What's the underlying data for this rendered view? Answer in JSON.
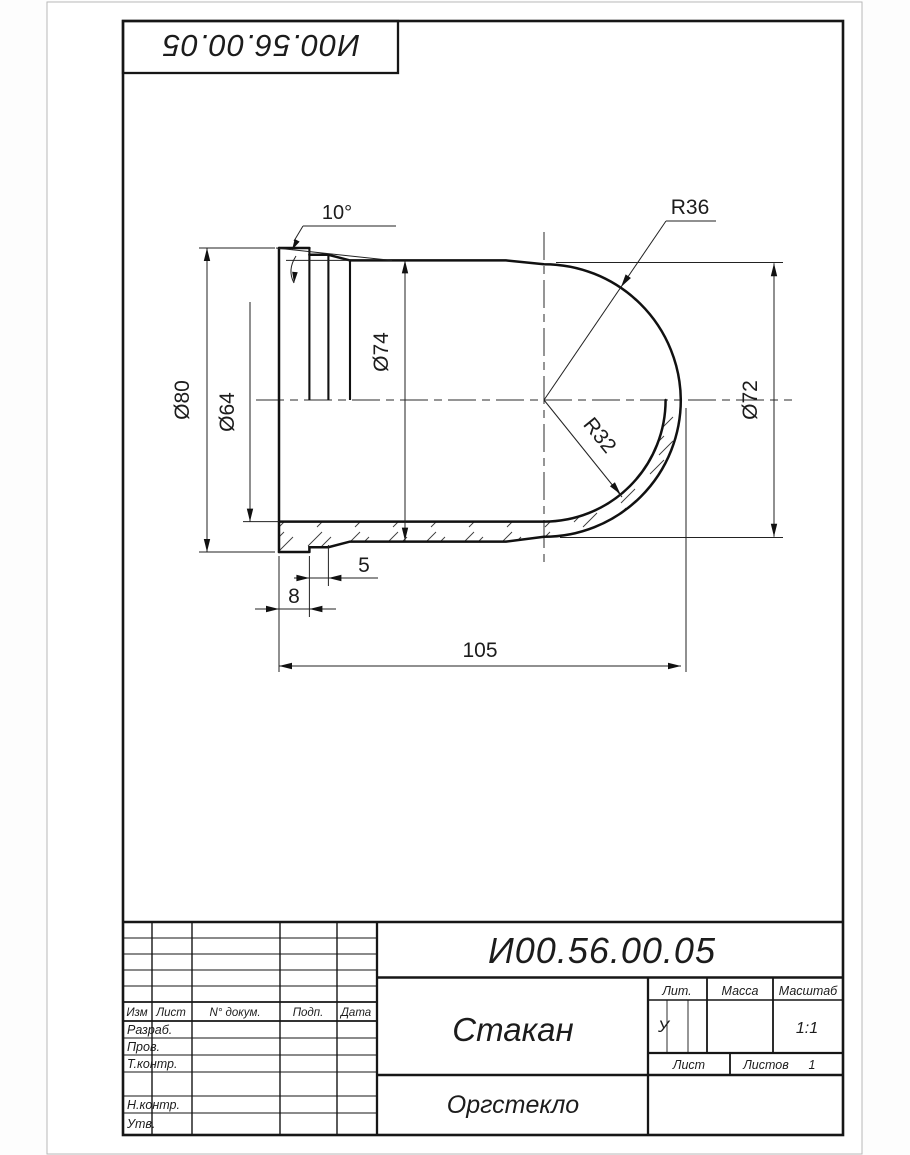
{
  "stamp": {
    "number": "И00.56.00.05"
  },
  "drawing": {
    "dims": {
      "angle": "10°",
      "r36": "R36",
      "r32": "R32",
      "d80": "Ø80",
      "d64": "Ø64",
      "d74": "Ø74",
      "d72": "Ø72",
      "len5": "5",
      "len8": "8",
      "len105": "105"
    }
  },
  "title_block": {
    "doc_number": "И00.56.00.05",
    "part_name": "Стакан",
    "material": "Оргстекло",
    "literal": "У",
    "scale_value": "1:1",
    "sheets_count": "1",
    "labels": {
      "lit": "Лит.",
      "mass": "Масса",
      "scale": "Масштаб",
      "sheet": "Лист",
      "sheets": "Листов",
      "izm": "Изм",
      "list": "Лист",
      "doc": "N° докум.",
      "sign": "Подп.",
      "date": "Дата",
      "razrab": "Разраб.",
      "prov": "Пров.",
      "tkontr": "Т.контр.",
      "nkontr": "Н.контр.",
      "utv": "Утв."
    }
  }
}
